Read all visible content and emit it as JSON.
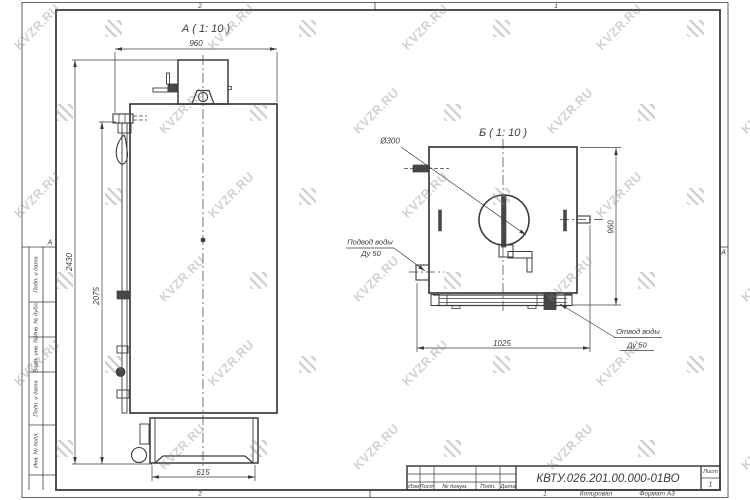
{
  "watermark": {
    "text": "KVZR.RU"
  },
  "frame": {
    "zones": {
      "top_left": "2",
      "top_right": "1",
      "bottom_left": "2",
      "bottom_right": "1",
      "left": "А",
      "right": "А"
    },
    "stamp_columns": [
      "Подп. и дата",
      "Инв. № дубл.",
      "Взам. инв. №",
      "Подп. и дата",
      "Инв. № подл."
    ]
  },
  "title_block": {
    "doc_number": "КВТУ.026.201.00.000-01ВО",
    "columns": [
      "Изм",
      "Лист",
      "№ докум.",
      "Подп.",
      "Дата"
    ],
    "sheet_label": "Лист",
    "sheet_number": "1",
    "copied_label": "Копировал",
    "format_label": "Формат А3"
  },
  "views": {
    "side": {
      "title": "А ( 1: 10 )",
      "dims": {
        "width_top": "960",
        "height_total": "2430",
        "height_body": "2075",
        "base_width": "615"
      }
    },
    "front": {
      "title": "Б ( 1: 10 )",
      "dims": {
        "diameter": "Ø300",
        "height": "960",
        "width": "1025"
      },
      "labels": {
        "inlet_line1": "Подвод воды",
        "inlet_line2": "Ду 50",
        "outlet_line1": "Отвод воды",
        "outlet_line2": "Ду 50"
      }
    }
  }
}
